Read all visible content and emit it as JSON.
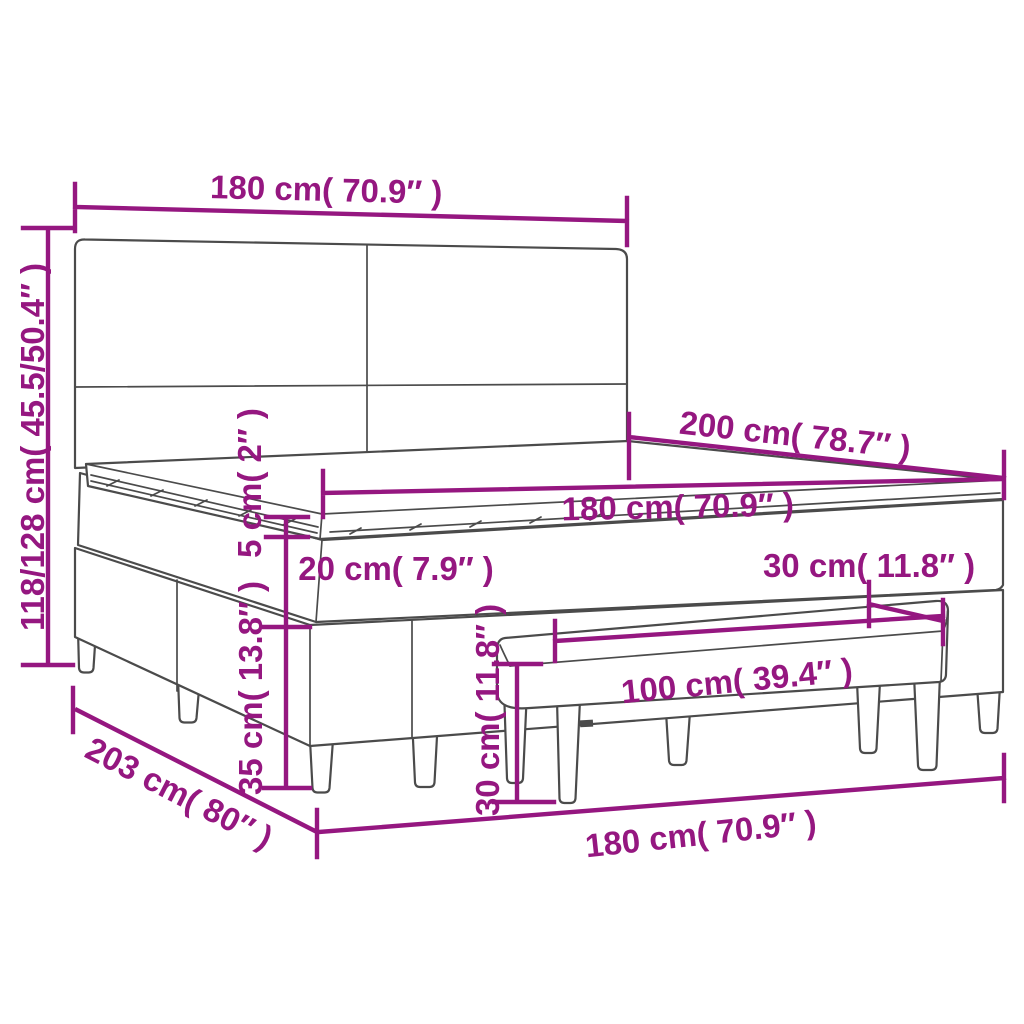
{
  "colors": {
    "accent": "#951780",
    "line": "#4b4b4b",
    "background": "#ffffff"
  },
  "diagram": {
    "subject": "box spring bed with headboard, mattress topper and bench",
    "view": "perspective dimension drawing"
  },
  "labels": {
    "headboard_width": "180 cm( 70.9″ )",
    "overall_height": "118/128 cm( 45.5/50.4″ )",
    "bed_length": "200 cm( 78.7″ )",
    "mattress_width": "180 cm( 70.9″ )",
    "topper_thickness": "5 cm( 2″ )",
    "mattress_thickness": "20 cm( 7.9″ )",
    "base_height": "35 cm( 13.8″ )",
    "bench_depth": "30 cm( 11.8″ )",
    "bench_width": "100 cm( 39.4″ )",
    "bench_height": "30 cm( 11.8″ )",
    "frame_floor_length": "203 cm( 80″ )",
    "frame_floor_width": "180 cm( 70.9″ )"
  }
}
